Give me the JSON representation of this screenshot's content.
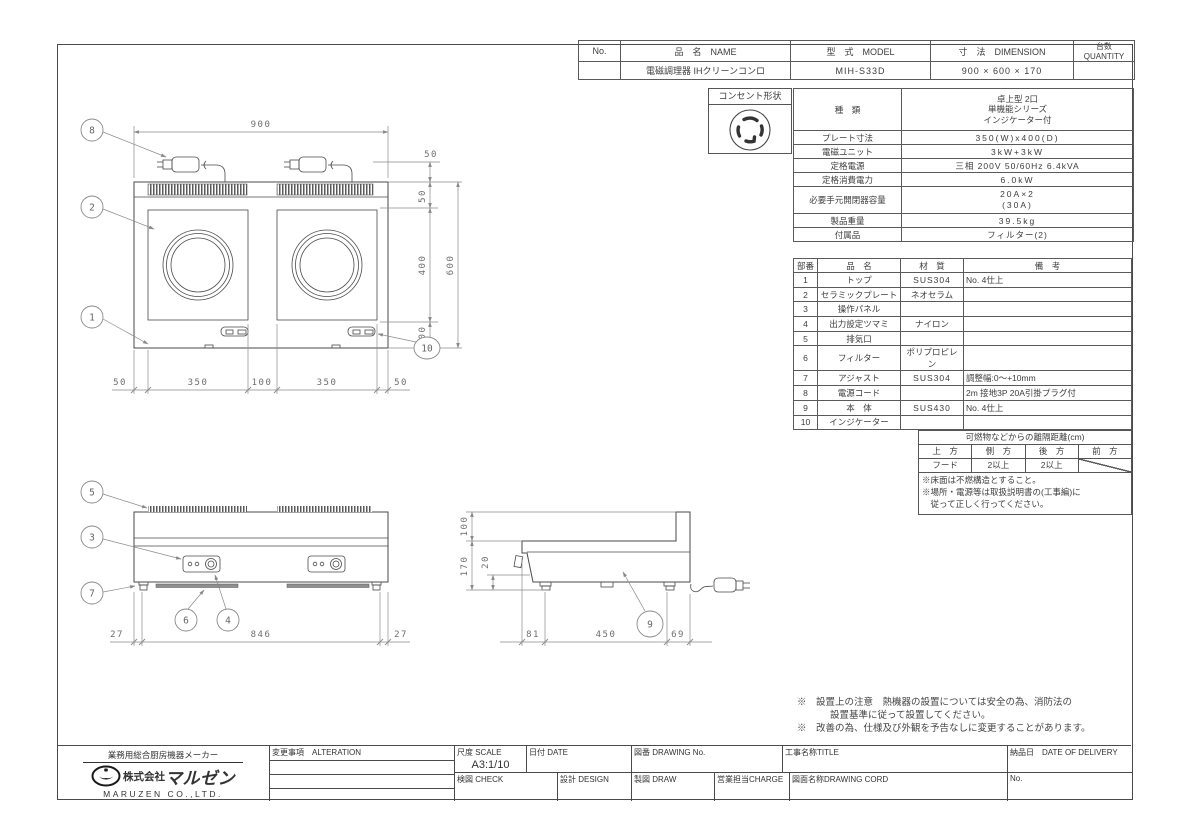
{
  "header_table": {
    "col_no": "No.",
    "col_name": "品　名　NAME",
    "col_model": "型　式　MODEL",
    "col_dimension": "寸　法　DIMENSION",
    "col_quantity": "台数 QUANTITY",
    "row": {
      "no": "",
      "name": "電磁調理器 IHクリーンコンロ",
      "model": "MIH-S33D",
      "dimension": "900 × 600 × 170",
      "quantity": ""
    }
  },
  "outlet": {
    "label": "コンセント形状"
  },
  "spec": {
    "rows": [
      {
        "label": "種　類",
        "value": "卓上型 2口\n単機能シリーズ\nインジケーター付"
      },
      {
        "label": "プレート寸法",
        "value": "350(W)x400(D)"
      },
      {
        "label": "電磁ユニット",
        "value": "3kW+3kW"
      },
      {
        "label": "定格電源",
        "value": "三相 200V 50/60Hz 6.4kVA"
      },
      {
        "label": "定格消費電力",
        "value": "6.0kW"
      },
      {
        "label": "必要手元開閉器容量",
        "value": "20A×2\n(30A)"
      },
      {
        "label": "製品重量",
        "value": "39.5kg"
      },
      {
        "label": "付属品",
        "value": "フィルター(2)"
      }
    ]
  },
  "parts": {
    "headers": [
      "部番",
      "品　名",
      "材　質",
      "備　考"
    ],
    "rows": [
      [
        "1",
        "トップ",
        "SUS304",
        "No. 4仕上"
      ],
      [
        "2",
        "セラミックプレート",
        "ネオセラム",
        ""
      ],
      [
        "3",
        "操作パネル",
        "",
        ""
      ],
      [
        "4",
        "出力設定ツマミ",
        "ナイロン",
        ""
      ],
      [
        "5",
        "排気口",
        "",
        ""
      ],
      [
        "6",
        "フィルター",
        "ポリプロピレン",
        ""
      ],
      [
        "7",
        "アジャスト",
        "SUS304",
        "調整幅:0〜+10mm"
      ],
      [
        "8",
        "電源コード",
        "",
        "2m 接地3P 20A引掛プラグ付"
      ],
      [
        "9",
        "本　体",
        "SUS430",
        "No. 4仕上"
      ],
      [
        "10",
        "インジケーター",
        "",
        ""
      ]
    ]
  },
  "clearance": {
    "title": "可燃物などからの離隔距離(cm)",
    "headers": [
      "上　方",
      "側　方",
      "後　方",
      "前　方"
    ],
    "values": [
      "フード",
      "2以上",
      "2以上",
      ""
    ],
    "notes": [
      "※床面は不燃構造とすること。",
      "※場所・電源等は取扱説明書の(工事編)に",
      "　従って正しく行ってください。"
    ]
  },
  "bottom_notes": [
    "※　設置上の注意　熱機器の設置については安全の為、消防法の",
    "設置基準に従って設置してください。",
    "※　改善の為、仕様及び外観を予告なしに変更することがあります。"
  ],
  "title_block": {
    "maker_tagline": "業務用総合厨房機器メーカー",
    "maker_prefix": "株式会社",
    "maker_name": "マルゼン",
    "maker_en": "MARUZEN CO.,LTD.",
    "alteration_label": "変更事項　ALTERATION",
    "scale_label": "尺度 SCALE",
    "scale_value": "A3:1/10",
    "date_label": "日付 DATE",
    "drawing_no_label": "図番 DRAWING No.",
    "title_label": "工事名称TITLE",
    "check_label": "検図 CHECK",
    "design_label": "設計 DESIGN",
    "draw_label": "製図 DRAW",
    "charge_label": "営業担当CHARGE",
    "drawing_cord_label": "図面名称DRAWING CORD",
    "delivery_label": "納品日　DATE OF DELIVERY",
    "no_label": "No."
  },
  "dims": {
    "plan": {
      "width": "900",
      "total_height": "600",
      "cord_offset": "50",
      "chain_right": [
        "50",
        "400",
        "100"
      ],
      "chain_bottom": [
        "50",
        "350",
        "100",
        "350",
        "50"
      ]
    },
    "front": {
      "chain": [
        "27",
        "846",
        "27"
      ]
    },
    "side": {
      "back_height": "100",
      "height": "170",
      "adjust": "20",
      "chain_bottom": [
        "81",
        "450",
        "69"
      ]
    }
  },
  "balloons": {
    "b1": "1",
    "b2": "2",
    "b3": "3",
    "b4": "4",
    "b5": "5",
    "b6": "6",
    "b7": "7",
    "b8": "8",
    "b9": "9",
    "b10": "10"
  }
}
